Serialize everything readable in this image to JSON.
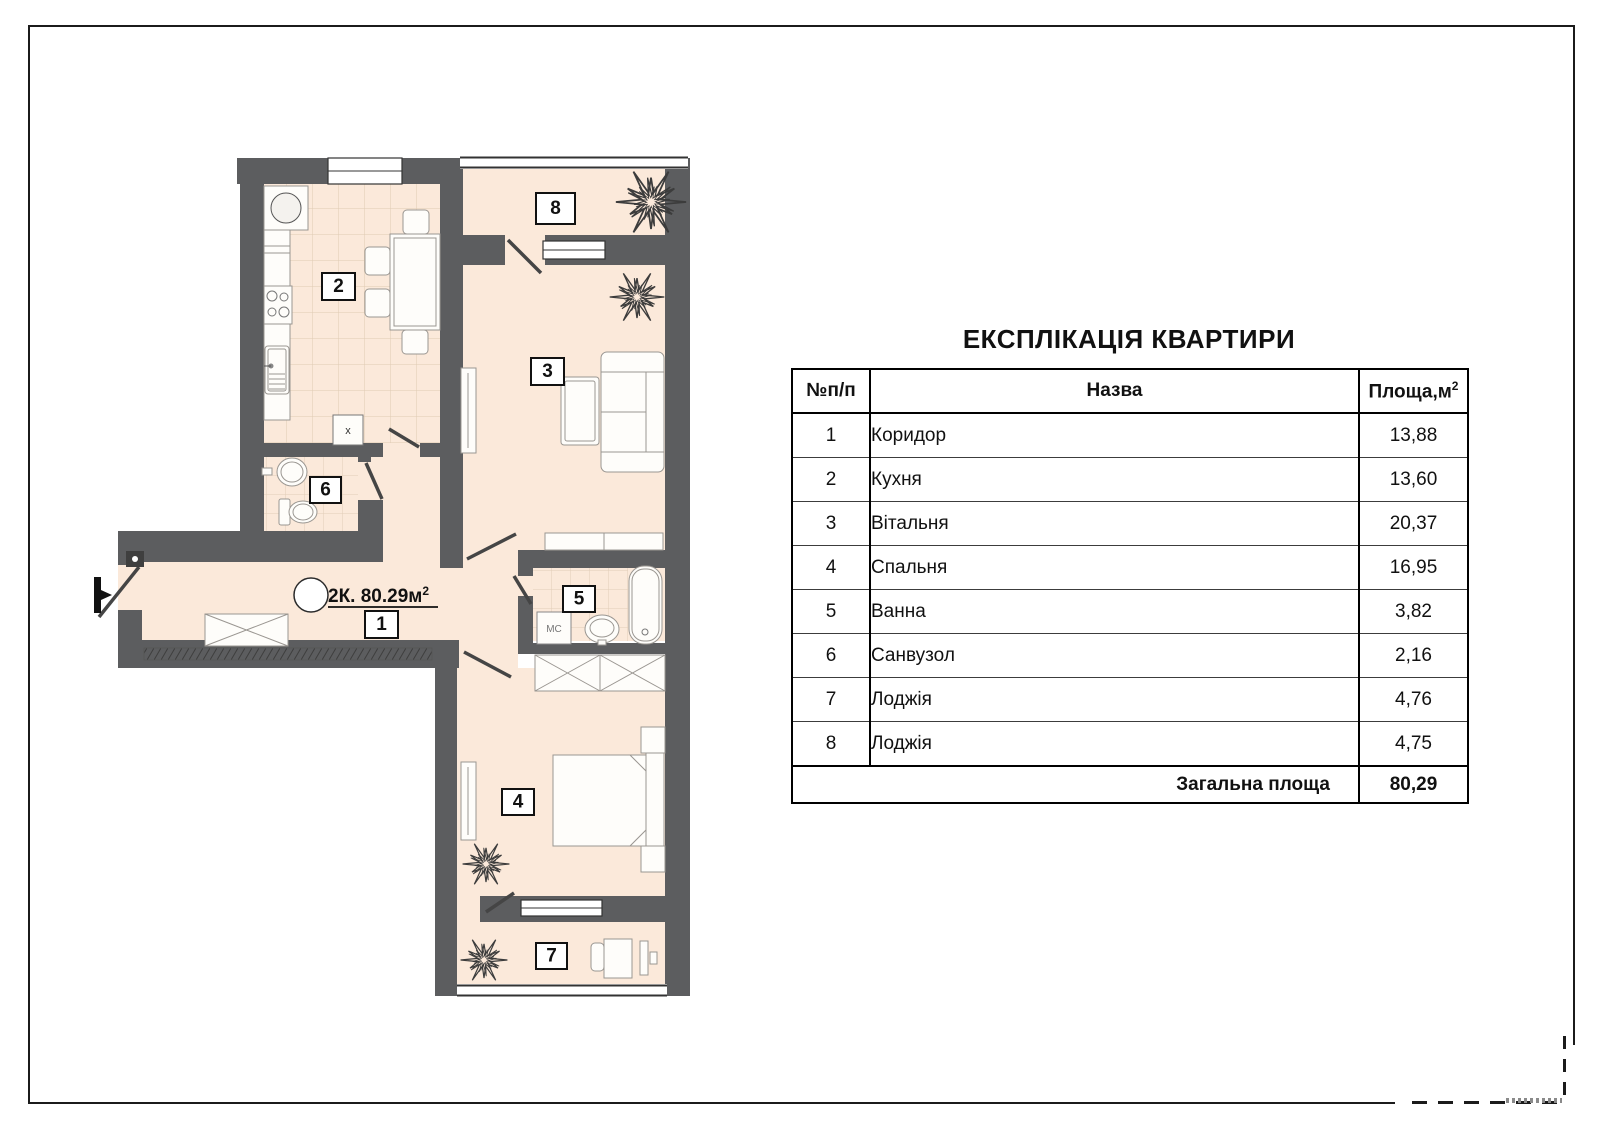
{
  "table": {
    "title": "ЕКСПЛІКАЦІЯ КВАРТИРИ",
    "headers": {
      "num": "№п/п",
      "name": "Назва",
      "area": "Площа,м",
      "area_sup": "2"
    },
    "rows": [
      {
        "num": "1",
        "name": "Коридор",
        "area": "13,88"
      },
      {
        "num": "2",
        "name": "Кухня",
        "area": "13,60"
      },
      {
        "num": "3",
        "name": "Вітальня",
        "area": "20,37"
      },
      {
        "num": "4",
        "name": "Спальня",
        "area": "16,95"
      },
      {
        "num": "5",
        "name": "Ванна",
        "area": "3,82"
      },
      {
        "num": "6",
        "name": "Санвузол",
        "area": "2,16"
      },
      {
        "num": "7",
        "name": "Лоджія",
        "area": "4,76"
      },
      {
        "num": "8",
        "name": "Лоджія",
        "area": "4,75"
      }
    ],
    "total": {
      "label": "Загальна площа",
      "value": "80,29"
    }
  },
  "plan": {
    "apartment_label": {
      "text": "2К. 80.29м",
      "sup": "2"
    },
    "room_numbers": {
      "r1": "1",
      "r2": "2",
      "r3": "3",
      "r4": "4",
      "r5": "5",
      "r6": "6",
      "r7": "7",
      "r8": "8"
    },
    "markers": {
      "shaft": "х",
      "closet": "МС"
    },
    "colors": {
      "wall": "#5c5d5f",
      "floor": "#fbe9da",
      "frame": "#1b1b1b"
    }
  }
}
